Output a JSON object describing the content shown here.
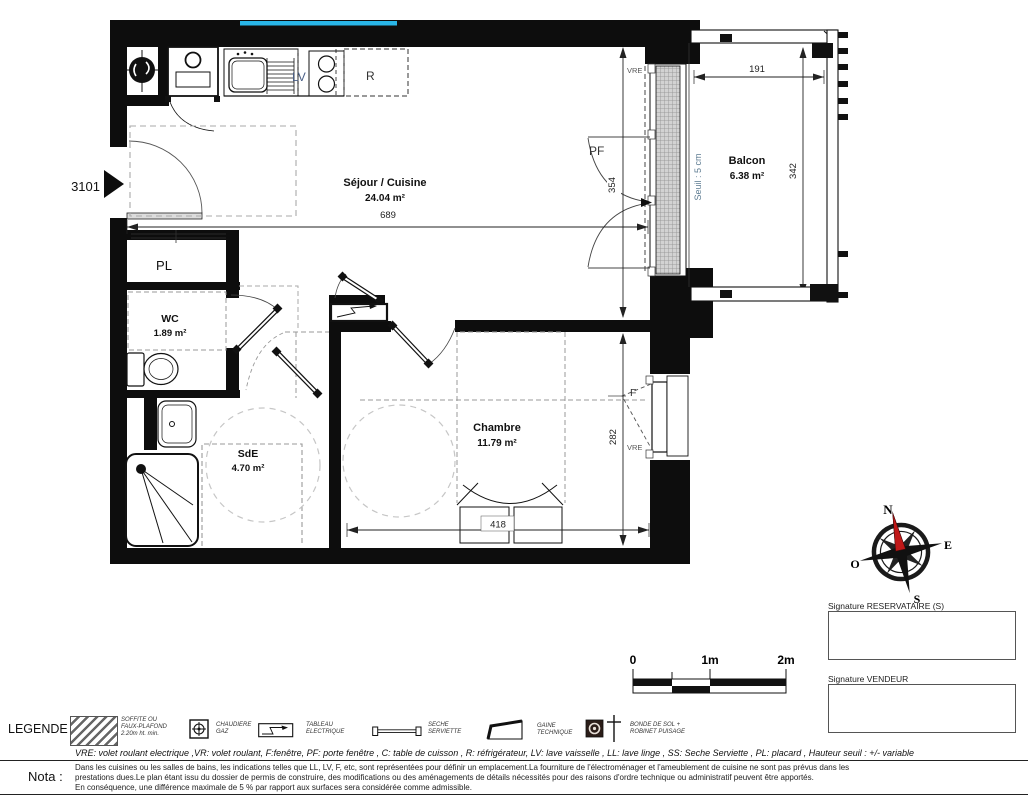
{
  "plan": {
    "unit": "3101",
    "rooms": {
      "sejour": {
        "name": "Séjour / Cuisine",
        "area": "24.04 m²"
      },
      "balcon": {
        "name": "Balcon",
        "area": "6.38 m²"
      },
      "wc": {
        "name": "WC",
        "area": "1.89 m²"
      },
      "sde": {
        "name": "SdE",
        "area": "4.70 m²"
      },
      "chambre": {
        "name": "Chambre",
        "area": "11.79 m²"
      },
      "placard": {
        "name": "PL"
      }
    },
    "tags": {
      "pf": "PF",
      "f": "F",
      "lv": "LV",
      "r": "R",
      "vre": "VRE",
      "seuil": "Seuil : 5 cm"
    },
    "dims": {
      "sejour_w": "689",
      "sejour_h": "354",
      "balcon_w": "191",
      "balcon_h": "342",
      "chambre_h": "282",
      "chambre_w": "418"
    }
  },
  "compass": {
    "north": "N",
    "east": "E",
    "south": "S",
    "west": "O"
  },
  "scalebar": {
    "zero": "0",
    "one": "1m",
    "two": "2m"
  },
  "signatures": {
    "reservataire": "Signature RESERVATAIRE (S)",
    "vendeur": "Signature VENDEUR"
  },
  "legend": {
    "title": "LEGENDE",
    "items": {
      "soffite": "SOFFITE OU\nFAUX-PLAFOND\n2.20m ht. min.",
      "chaudiere": "CHAUDIERE\nGAZ",
      "tableau": "TABLEAU\nELECTRIQUE",
      "seche": "SECHE\nSERVIETTE",
      "gaine": "GAINE\nTECHNIQUE",
      "bonde": "BONDE DE SOL +\nROBINET PUISAGE"
    },
    "abbreviations": "VRE: volet roulant electrique ,VR: volet roulant, F:fenêtre, PF: porte fenêtre , C: table de cuisson , R: réfrigérateur, LV: lave vaisselle , LL: lave linge , SS: Seche Serviette , PL: placard , Hauteur seuil : +/- variable"
  },
  "nota": {
    "title": "Nota :",
    "lines": [
      "Dans les cuisines ou les salles de bains, les indications telles que LL, LV, F, etc, sont représentées pour définir un emplacement.La fourniture de l'électroménager et l'ameublement de cuisine ne sont pas prévus dans les",
      "prestations dues.Le plan étant issu du dossier de permis de construire, des modifications ou des aménagements de détails nécessités pour des raisons d'ordre technique ou administratif peuvent être apportés.",
      "En conséquence, une différence maximale de 5 % par rapport aux surfaces sera considérée comme admissible."
    ]
  },
  "colors": {
    "window_accent": "#29b6e8",
    "compass_needle": "#c01818",
    "seuil_text": "#5f7d93"
  }
}
